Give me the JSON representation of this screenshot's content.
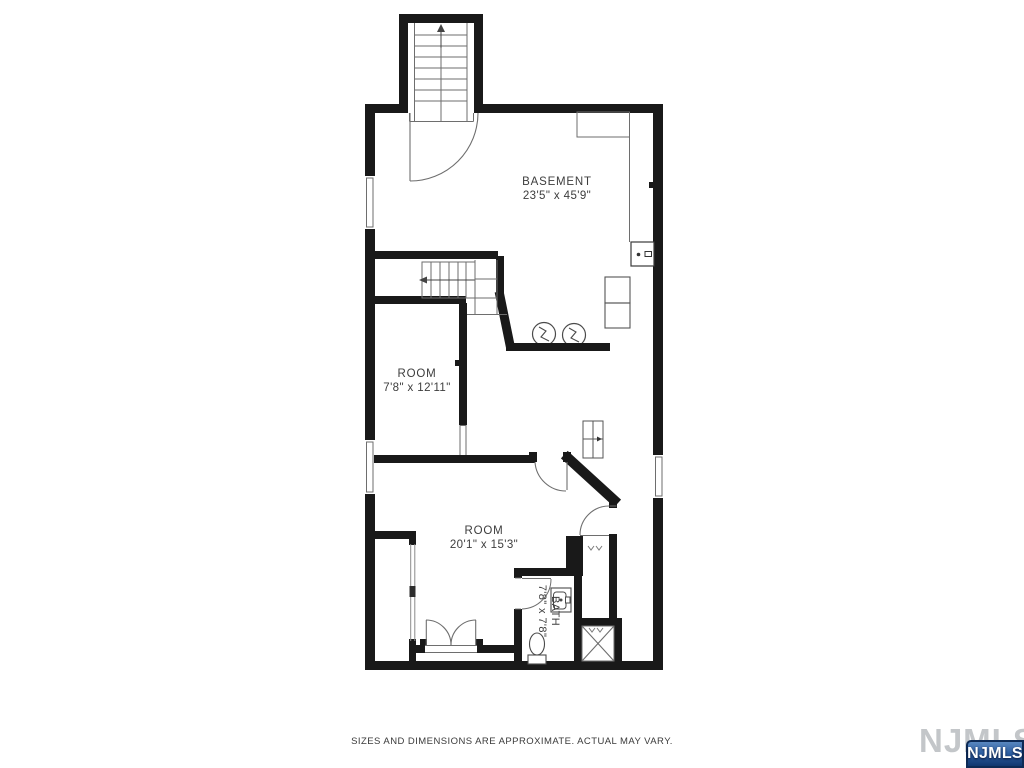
{
  "page": {
    "background": "#ffffff"
  },
  "floor_plan": {
    "rooms": {
      "basement": {
        "name": "BASEMENT",
        "dims": "23'5\" x 45'9\""
      },
      "room_small": {
        "name": "ROOM",
        "dims": "7'8\" x 12'11\""
      },
      "room_large": {
        "name": "ROOM",
        "dims": "20'1\" x 15'3\""
      },
      "bath": {
        "name": "BATH",
        "dims": "7'8\" x 7'8\""
      }
    },
    "colors": {
      "wall": "#191919",
      "thin_line": "#6e6e6e",
      "fixture_line": "#4a4a4a",
      "label_text": "#3d3d3d"
    }
  },
  "footer": {
    "disclaimer": "SIZES AND DIMENSIONS ARE APPROXIMATE. ACTUAL MAY VARY."
  },
  "branding": {
    "watermark_text": "NJMLS",
    "badge_text": "NJMLS",
    "watermark_color": "#c3c6c9",
    "badge_border": "#0d2a55",
    "badge_gradient_top": "#5987bf",
    "badge_gradient_bottom": "#11366f"
  }
}
